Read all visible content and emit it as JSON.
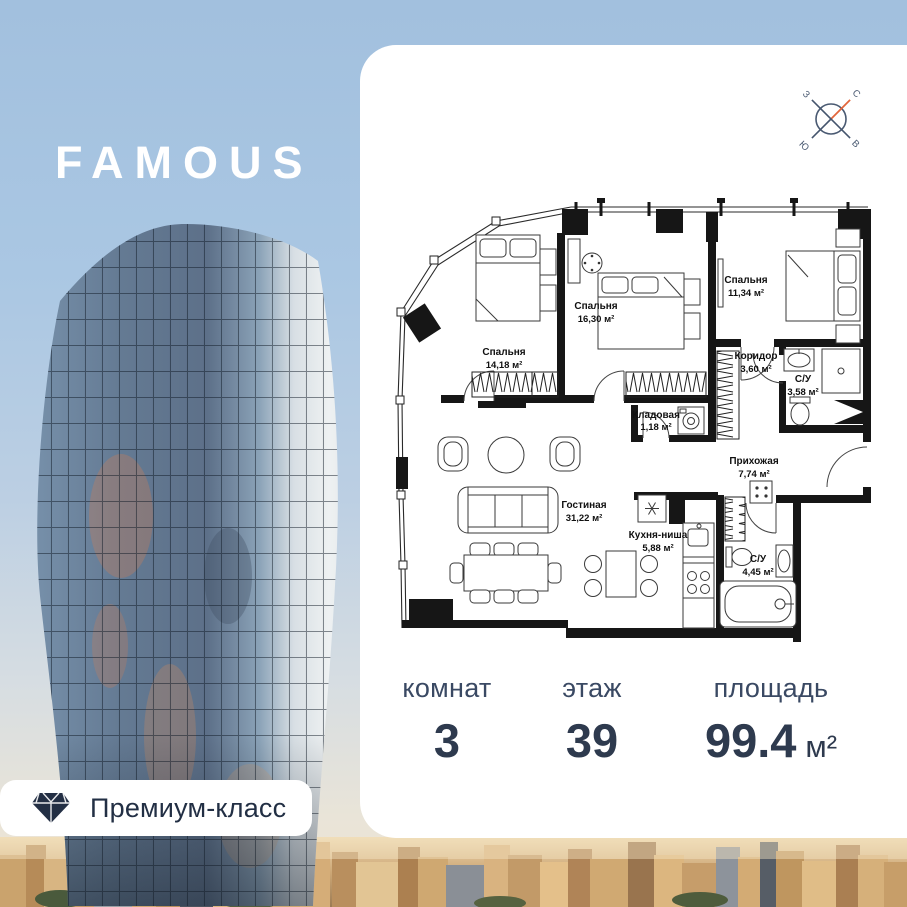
{
  "brand": {
    "logo": "FAMOUS"
  },
  "badge": {
    "label": "Премиум-класс",
    "icon": "diamond-icon"
  },
  "compass": {
    "north": "С",
    "east": "В",
    "south": "Ю",
    "west": "З",
    "north_color": "#e2663c"
  },
  "floorplan": {
    "rooms": [
      {
        "name": "Спальня",
        "area": "14,18 м²"
      },
      {
        "name": "Спальня",
        "area": "16,30 м²"
      },
      {
        "name": "Спальня",
        "area": "11,34 м²"
      },
      {
        "name": "Коридор",
        "area": "3,60 м²"
      },
      {
        "name": "С/У",
        "area": "3,58 м²"
      },
      {
        "name": "Кладовая",
        "area": "1,18 м²"
      },
      {
        "name": "Прихожая",
        "area": "7,74 м²"
      },
      {
        "name": "Гостиная",
        "area": "31,22 м²"
      },
      {
        "name": "Кухня-ниша",
        "area": "5,88 м²"
      },
      {
        "name": "С/У",
        "area": "4,45 м²"
      }
    ]
  },
  "stats": {
    "rooms": {
      "label": "комнат",
      "value": "3"
    },
    "floor": {
      "label": "этаж",
      "value": "39"
    },
    "area": {
      "label": "площадь",
      "value": "99.4",
      "unit": "м²"
    }
  },
  "colors": {
    "accent_navy": "#2e3a4e",
    "compass_north": "#e2663c",
    "card_bg": "#ffffff",
    "sky": "#aac7e3"
  }
}
